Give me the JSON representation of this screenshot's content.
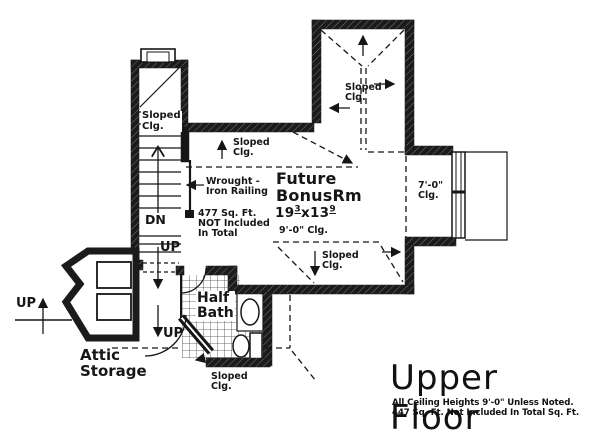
{
  "plan": {
    "paper_color": "#ffffff",
    "ink_color": "#161616",
    "labels": {
      "sloped_clg": {
        "line1": "Sloped",
        "line2": "Clg."
      },
      "dn": "DN",
      "up": "UP",
      "wrought": {
        "line1": "Wrought -",
        "line2": "Iron Railing"
      },
      "sqft_note": {
        "line1": "477 Sq. Ft.",
        "line2": "NOT Included",
        "line3": "In Total"
      },
      "bonus_room": {
        "line1": "Future",
        "line2": "BonusRm"
      },
      "bonus_dims": {
        "feet_w": "19",
        "in_w": "3",
        "sep": "x",
        "feet_h": "13",
        "in_h": "9"
      },
      "bonus_clg": "9'-0\" Clg.",
      "clg_7": {
        "line1": "7'-0\"",
        "line2": "Clg."
      },
      "half_bath": {
        "line1": "Half",
        "line2": "Bath"
      },
      "attic": {
        "line1": "Attic",
        "line2": "Storage"
      }
    },
    "title_block": {
      "title": "Upper Floor",
      "note1": "All Ceiling Heights 9'-0\" Unless Noted.",
      "note2": "447 Sq. Ft. Not Included In Total Sq. Ft."
    }
  }
}
